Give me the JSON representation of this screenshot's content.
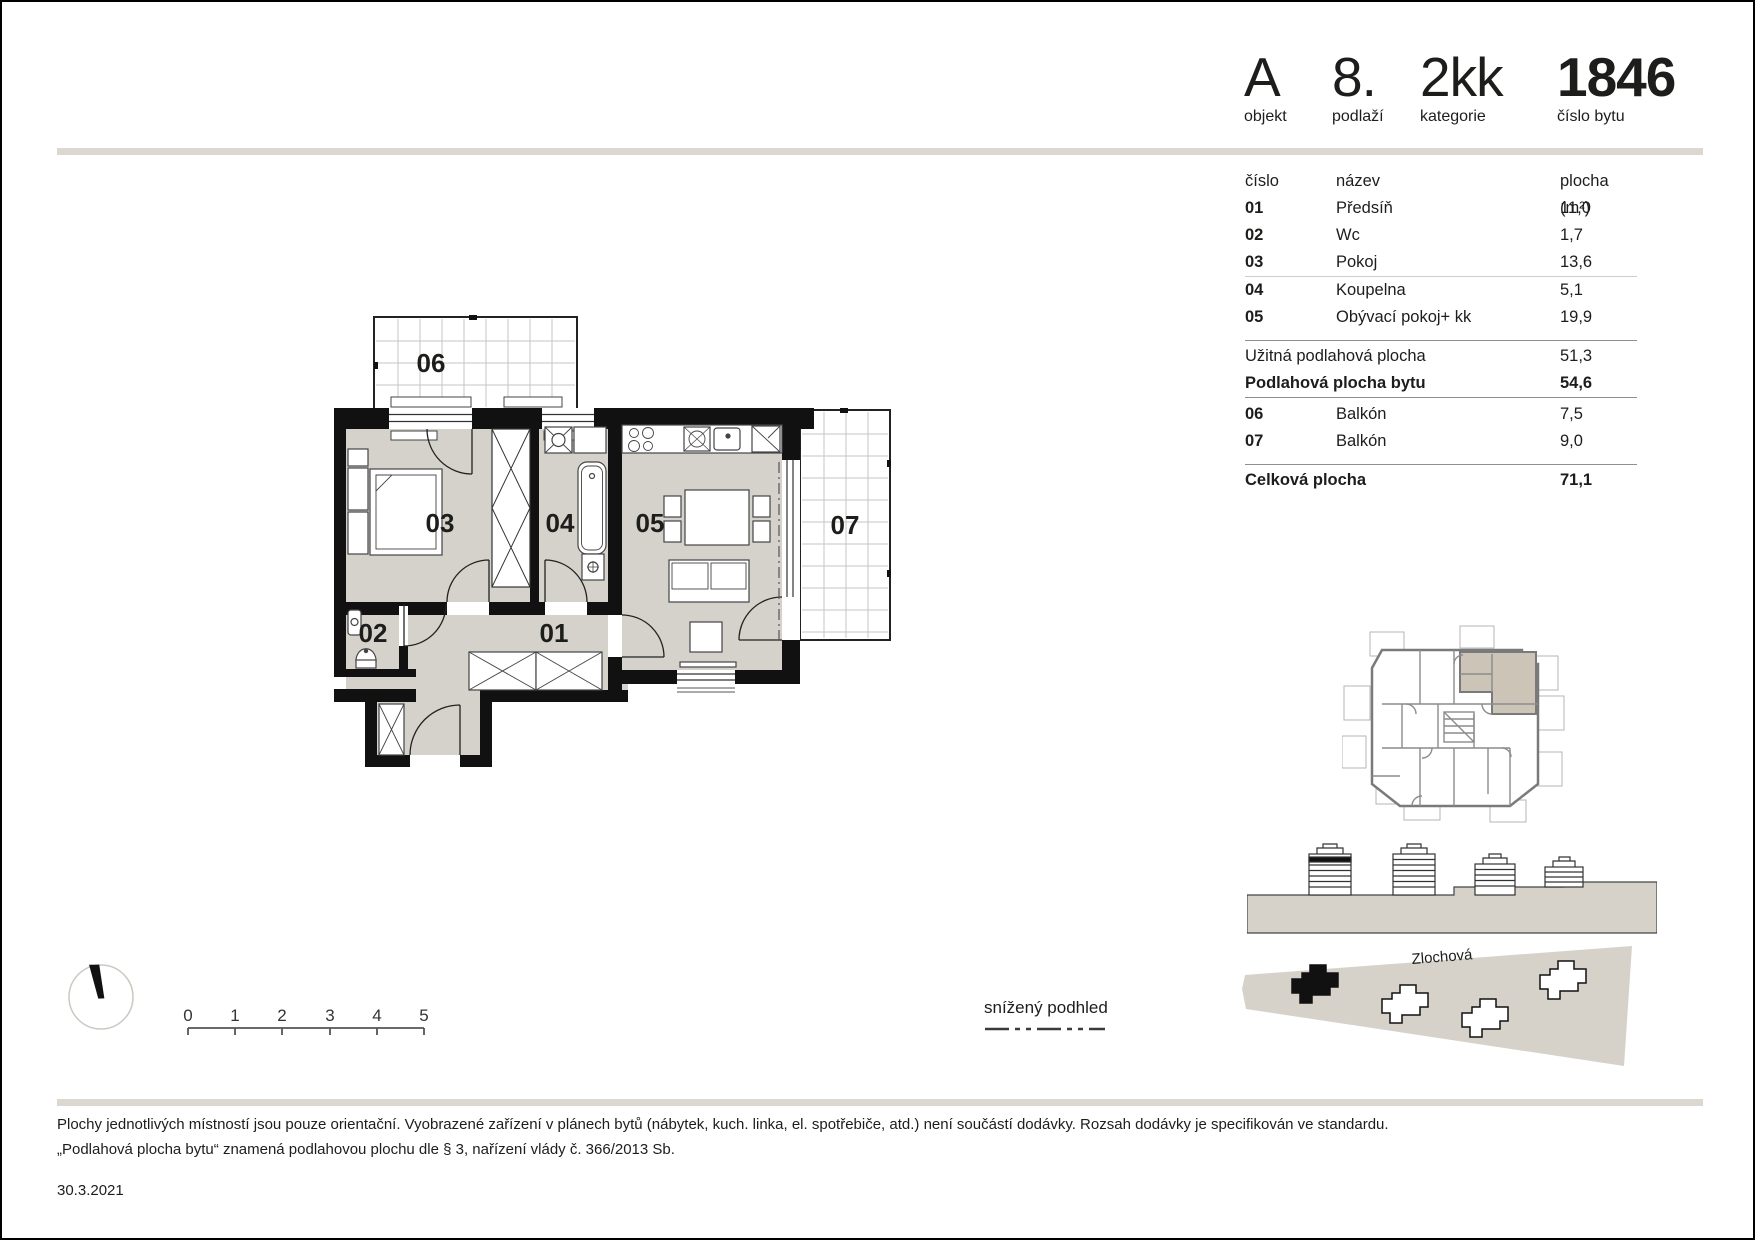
{
  "header": {
    "items": [
      {
        "value": "A",
        "label": "objekt"
      },
      {
        "value": "8.",
        "label": "podlaží"
      },
      {
        "value": "2kk",
        "label": "kategorie"
      },
      {
        "value": "1846",
        "label": "číslo bytu"
      }
    ]
  },
  "table": {
    "columns": [
      "číslo",
      "název",
      "plocha (m²)"
    ],
    "rooms": [
      {
        "num": "01",
        "name": "Předsíň",
        "area": "11,0"
      },
      {
        "num": "02",
        "name": "Wc",
        "area": "1,7"
      },
      {
        "num": "03",
        "name": "Pokoj",
        "area": "13,6"
      },
      {
        "num": "04",
        "name": "Koupelna",
        "area": "5,1"
      },
      {
        "num": "05",
        "name": "Obývací pokoj+ kk",
        "area": "19,9"
      }
    ],
    "summary_rows": [
      {
        "label": "Užitná podlahová plocha",
        "value": "51,3"
      },
      {
        "label": "Podlahová plocha bytu",
        "value": "54,6"
      }
    ],
    "balconies": [
      {
        "num": "06",
        "name": "Balkón",
        "area": "7,5"
      },
      {
        "num": "07",
        "name": "Balkón",
        "area": "9,0"
      }
    ],
    "total": {
      "label": "Celková plocha",
      "value": "71,1"
    }
  },
  "plan": {
    "labels": {
      "r01": "01",
      "r02": "02",
      "r03": "03",
      "r04": "04",
      "r05": "05",
      "r06": "06",
      "r07": "07"
    }
  },
  "legend": {
    "lowered_ceiling": "snížený podhled"
  },
  "scale": {
    "ticks": [
      "0",
      "1",
      "2",
      "3",
      "4",
      "5"
    ]
  },
  "site": {
    "street": "Zlochová"
  },
  "footer": {
    "line1": "Plochy jednotlivých místností jsou pouze orientační. Vyobrazené zařízení v plánech bytů (nábytek, kuch. linka, el. spotřebiče, atd.) není součástí dodávky. Rozsah dodávky je specifikován ve standardu.",
    "line2": "„Podlahová plocha bytu“ znamená podlahovou plochu dle § 3, nařízení vlády č. 366/2013 Sb.",
    "date": "30.3.2021"
  },
  "colors": {
    "wall": "#111111",
    "room_fill": "#d5d2cb",
    "ground": "#d6d2c9",
    "highlight": "#ccc4b6",
    "divider": "#dcd8d1"
  }
}
